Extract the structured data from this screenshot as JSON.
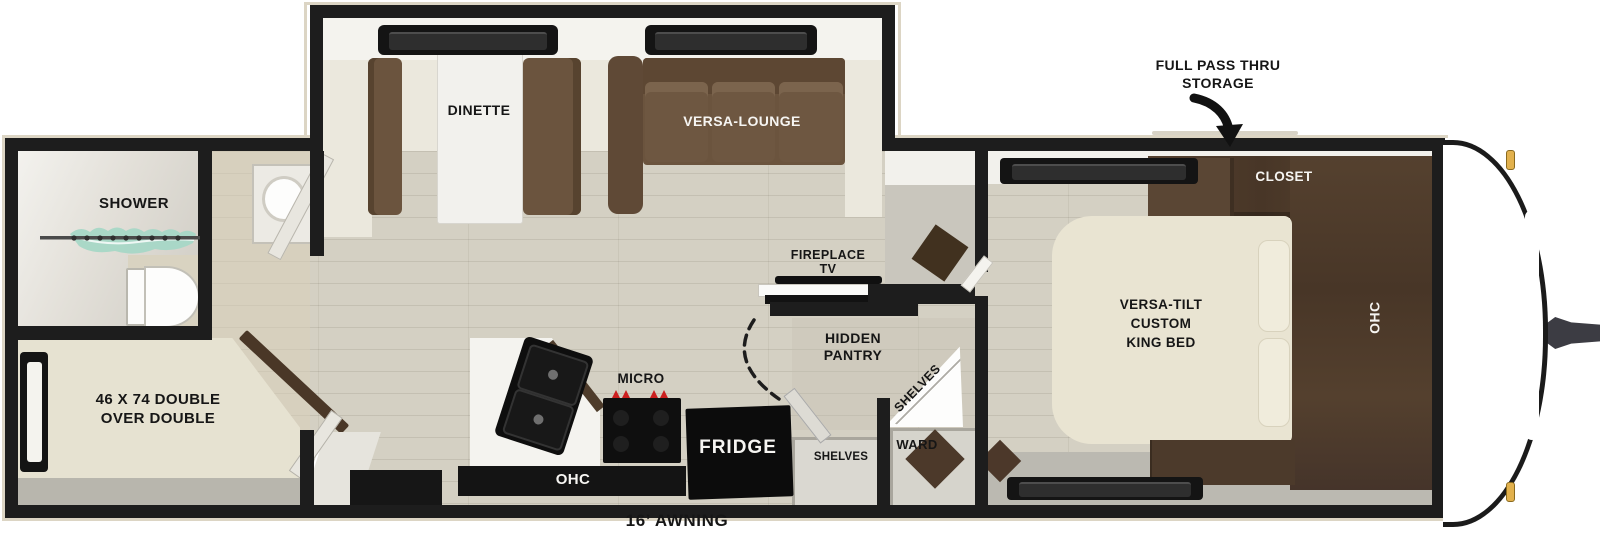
{
  "labels": {
    "storage1": "FULL PASS THRU",
    "storage2": "STORAGE",
    "awning": "16’ AWNING",
    "dinette": "DINETTE",
    "lounge": "VERSA-LOUNGE",
    "shower": "SHOWER",
    "bunk1": "46 X 74 DOUBLE",
    "bunk2": "OVER DOUBLE",
    "fire1": "FIREPLACE",
    "fire2": "TV",
    "pantry1": "HIDDEN",
    "pantry2": "PANTRY",
    "shelves_corner": "SHELVES",
    "shelves_closet": "SHELVES",
    "ward": "WARD",
    "micro": "MICRO",
    "fridge": "FRIDGE",
    "ohc_kitchen": "OHC",
    "closet": "CLOSET",
    "ohc_bedroom": "OHC",
    "bed1": "VERSA-TILT",
    "bed2": "CUSTOM",
    "bed3": "KING BED"
  },
  "colors": {
    "wall": "#1d1d1d",
    "exterior_trim": "#dcd5c4",
    "floor": "#d4d0c3",
    "sofa_brown": "#6b543e",
    "cabinet_dark_brown": "#4c3a2b",
    "bed_cream": "#e9e4d2",
    "counter_white": "#f4f3ef",
    "shower_curtain_teal": "#a7d7c6",
    "burner_red": "#cc1f1f",
    "clearance_light_amber": "#e2b14d",
    "appliance_black": "#0e0e0e"
  }
}
